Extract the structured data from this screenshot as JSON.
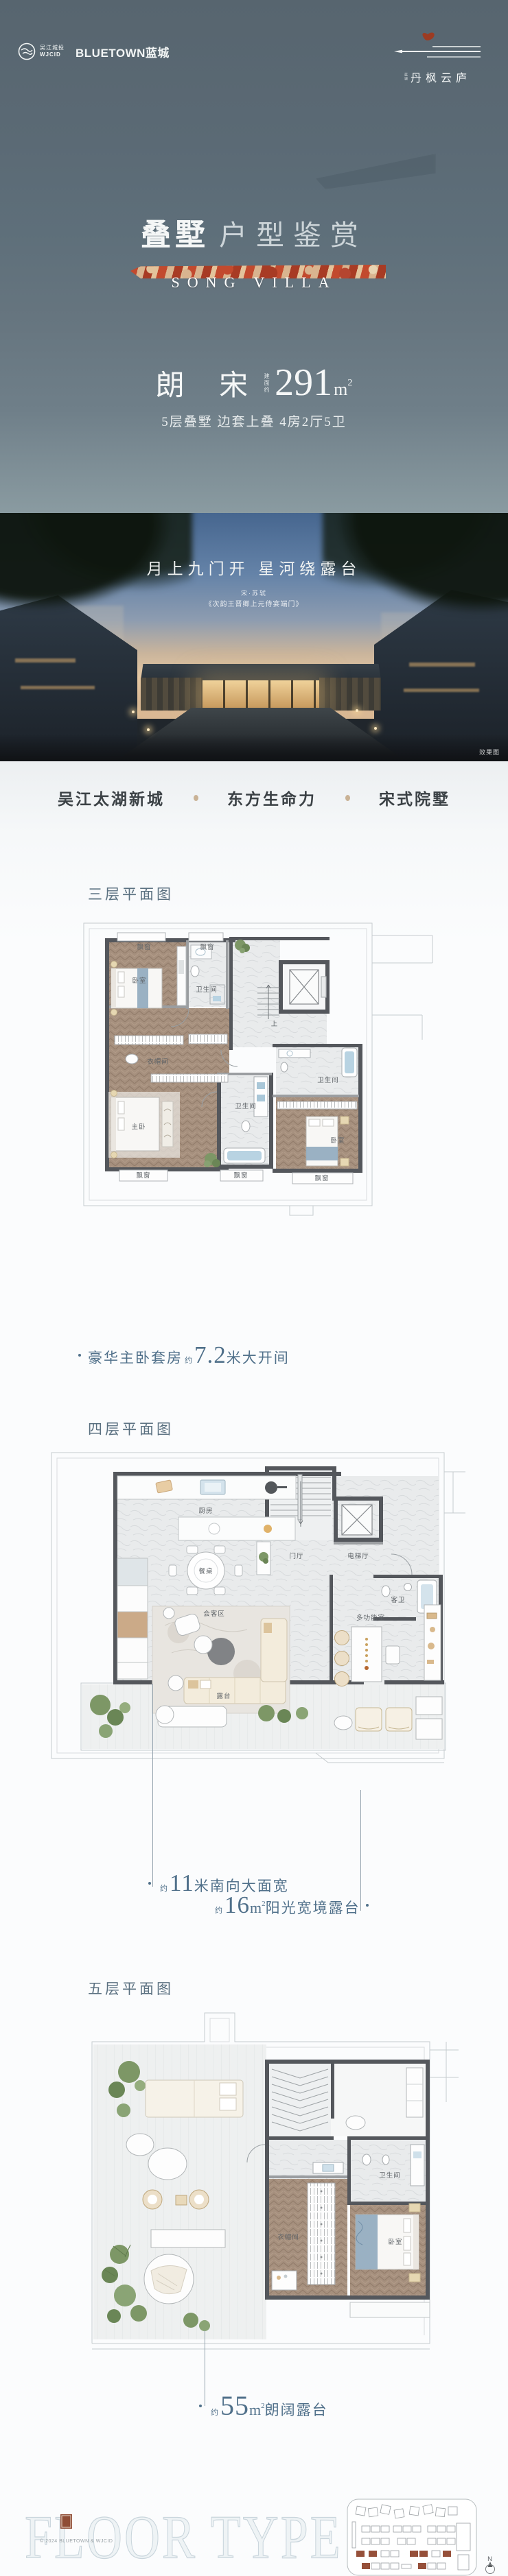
{
  "header": {
    "wjcid_cn": "吴江城投",
    "wjcid_en": "WJCID",
    "bluetown": "BLUETOWN蓝城",
    "project_prefix": "蓝城",
    "project_name": "丹枫云庐"
  },
  "hero": {
    "title": "叠墅",
    "subtitle": "户型鉴赏",
    "banner_en": "SONG VILLA",
    "product": "朗 宋",
    "area_label": "建面约",
    "area_value": "291",
    "area_unit": "m",
    "area_sup": "2",
    "specs": "5层叠墅 边套上叠 4房2厅5卫"
  },
  "showcase": {
    "slogan": "月上九门开 星河绕露台",
    "poet": "宋·苏轼",
    "poem": "《次韵王晋卿上元侍宴端门》",
    "render_note": "效果图"
  },
  "features": {
    "items": [
      "吴江太湖新城",
      "东方生命力",
      "宋式院墅"
    ]
  },
  "plans": [
    {
      "label": "三层平面图",
      "rooms": {
        "bedroom_top": "卧室",
        "bath_top": "卫生间",
        "closet": "衣帽间",
        "master": "主卧",
        "bath_mid": "卫生间",
        "bath_right": "卫生间",
        "bedroom_right": "卧室",
        "stair_up": "上",
        "bay": "飘窗"
      },
      "caption": {
        "prefix": "豪华主卧套房",
        "approx": "约",
        "value": "7.2",
        "suffix": "米大开间"
      }
    },
    {
      "label": "四层平面图",
      "rooms": {
        "kitchen": "厨房",
        "dining_table": "餐桌",
        "foyer": "门厅",
        "elevator_hall": "电梯厅",
        "guest_bath": "客卫",
        "living": "会客区",
        "multi_room": "多功能室",
        "terrace": "露台"
      },
      "captions": [
        {
          "approx": "约",
          "value": "11",
          "suffix": "米南向大面宽"
        },
        {
          "approx": "约",
          "value": "16",
          "unit": "m",
          "sup": "2",
          "suffix": "阳光宽境露台"
        }
      ]
    },
    {
      "label": "五层平面图",
      "rooms": {
        "bath": "卫生间",
        "closet": "衣帽间",
        "bedroom": "卧室"
      },
      "caption": {
        "approx": "约",
        "value": "55",
        "unit": "m",
        "sup": "2",
        "suffix": "朗阔露台"
      }
    }
  ],
  "footer": {
    "watermark": "FLOOR TYPE",
    "copyright": "© 2024 BLUETOWN & WJCID",
    "compass": "N"
  }
}
